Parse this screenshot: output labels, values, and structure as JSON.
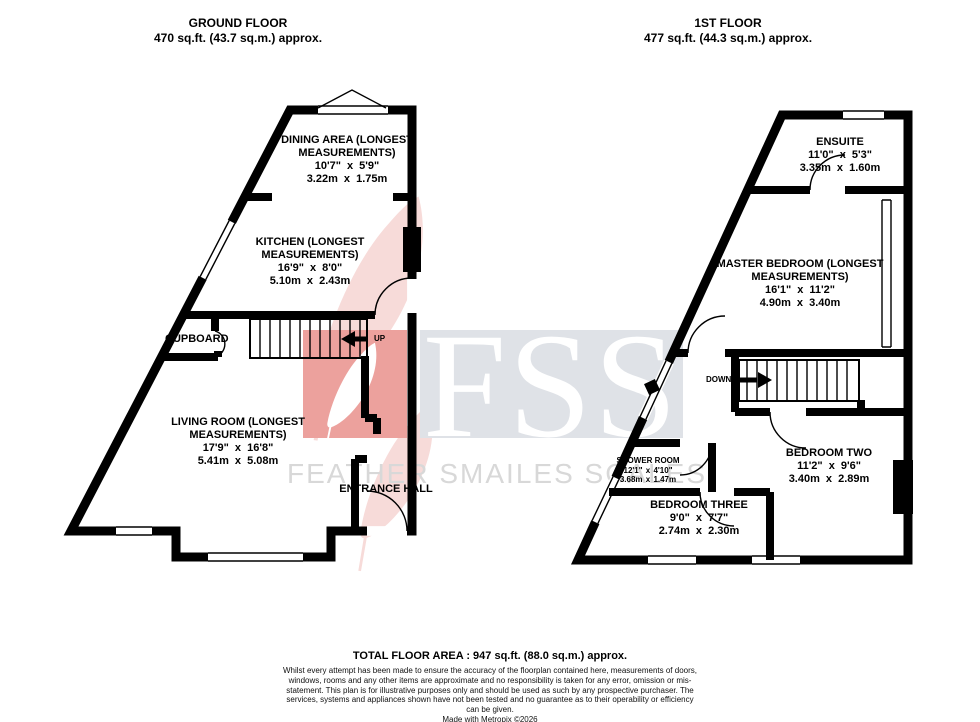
{
  "header": {
    "ground_title": "GROUND FLOOR",
    "ground_area": "470 sq.ft. (43.7 sq.m.) approx.",
    "first_title": "1ST FLOOR",
    "first_area": "477 sq.ft. (44.3 sq.m.) approx."
  },
  "ground_floor": {
    "rooms": [
      {
        "name": "DINING AREA (LONGEST MEASUREMENTS)",
        "imperial": "10'7\" x 5'9\"",
        "metric": "3.22m x 1.75m"
      },
      {
        "name": "KITCHEN (LONGEST MEASUREMENTS)",
        "imperial": "16'9\" x 8'0\"",
        "metric": "5.10m x 2.43m"
      },
      {
        "name": "LIVING ROOM (LONGEST MEASUREMENTS)",
        "imperial": "17'9\" x 16'8\"",
        "metric": "5.41m x 5.08m"
      }
    ],
    "labels": {
      "cupboard": "CUPBOARD",
      "entrance_hall": "ENTRANCE HALL",
      "up": "UP"
    }
  },
  "first_floor": {
    "rooms": [
      {
        "name": "ENSUITE",
        "imperial": "11'0\" x 5'3\"",
        "metric": "3.35m x 1.60m"
      },
      {
        "name": "MASTER BEDROOM (LONGEST MEASUREMENTS)",
        "imperial": "16'1\" x 11'2\"",
        "metric": "4.90m x 3.40m"
      },
      {
        "name": "BEDROOM TWO",
        "imperial": "11'2\" x 9'6\"",
        "metric": "3.40m x 2.89m"
      },
      {
        "name": "SHOWER ROOM",
        "imperial": "12'1\" x 4'10\"",
        "metric": "3.68m x 1.47m"
      },
      {
        "name": "BEDROOM THREE",
        "imperial": "9'0\" x 7'7\"",
        "metric": "2.74m x 2.30m"
      }
    ],
    "labels": {
      "down": "DOWN"
    }
  },
  "watermark": {
    "monogram": "FSS",
    "brand": "FEATHER SMAILES SCALES",
    "red": "#eca19d",
    "pale_red": "#f7dbd9",
    "gray_box": "#dfe2e7",
    "text_gray": "#d8d8d8"
  },
  "footer": {
    "total": "TOTAL FLOOR AREA : 947 sq.ft. (88.0 sq.m.) approx.",
    "disclaimer": "Whilst every attempt has been made to ensure the accuracy of the floorplan contained here, measurements of doors, windows, rooms and any other items are approximate and no responsibility is taken for any error, omission or mis-statement. This plan is for illustrative purposes only and should be used as such by any prospective purchaser. The services, systems and appliances shown have not been tested and no guarantee as to their operability or efficiency can be given.",
    "credit": "Made with Metropix ©2026"
  }
}
